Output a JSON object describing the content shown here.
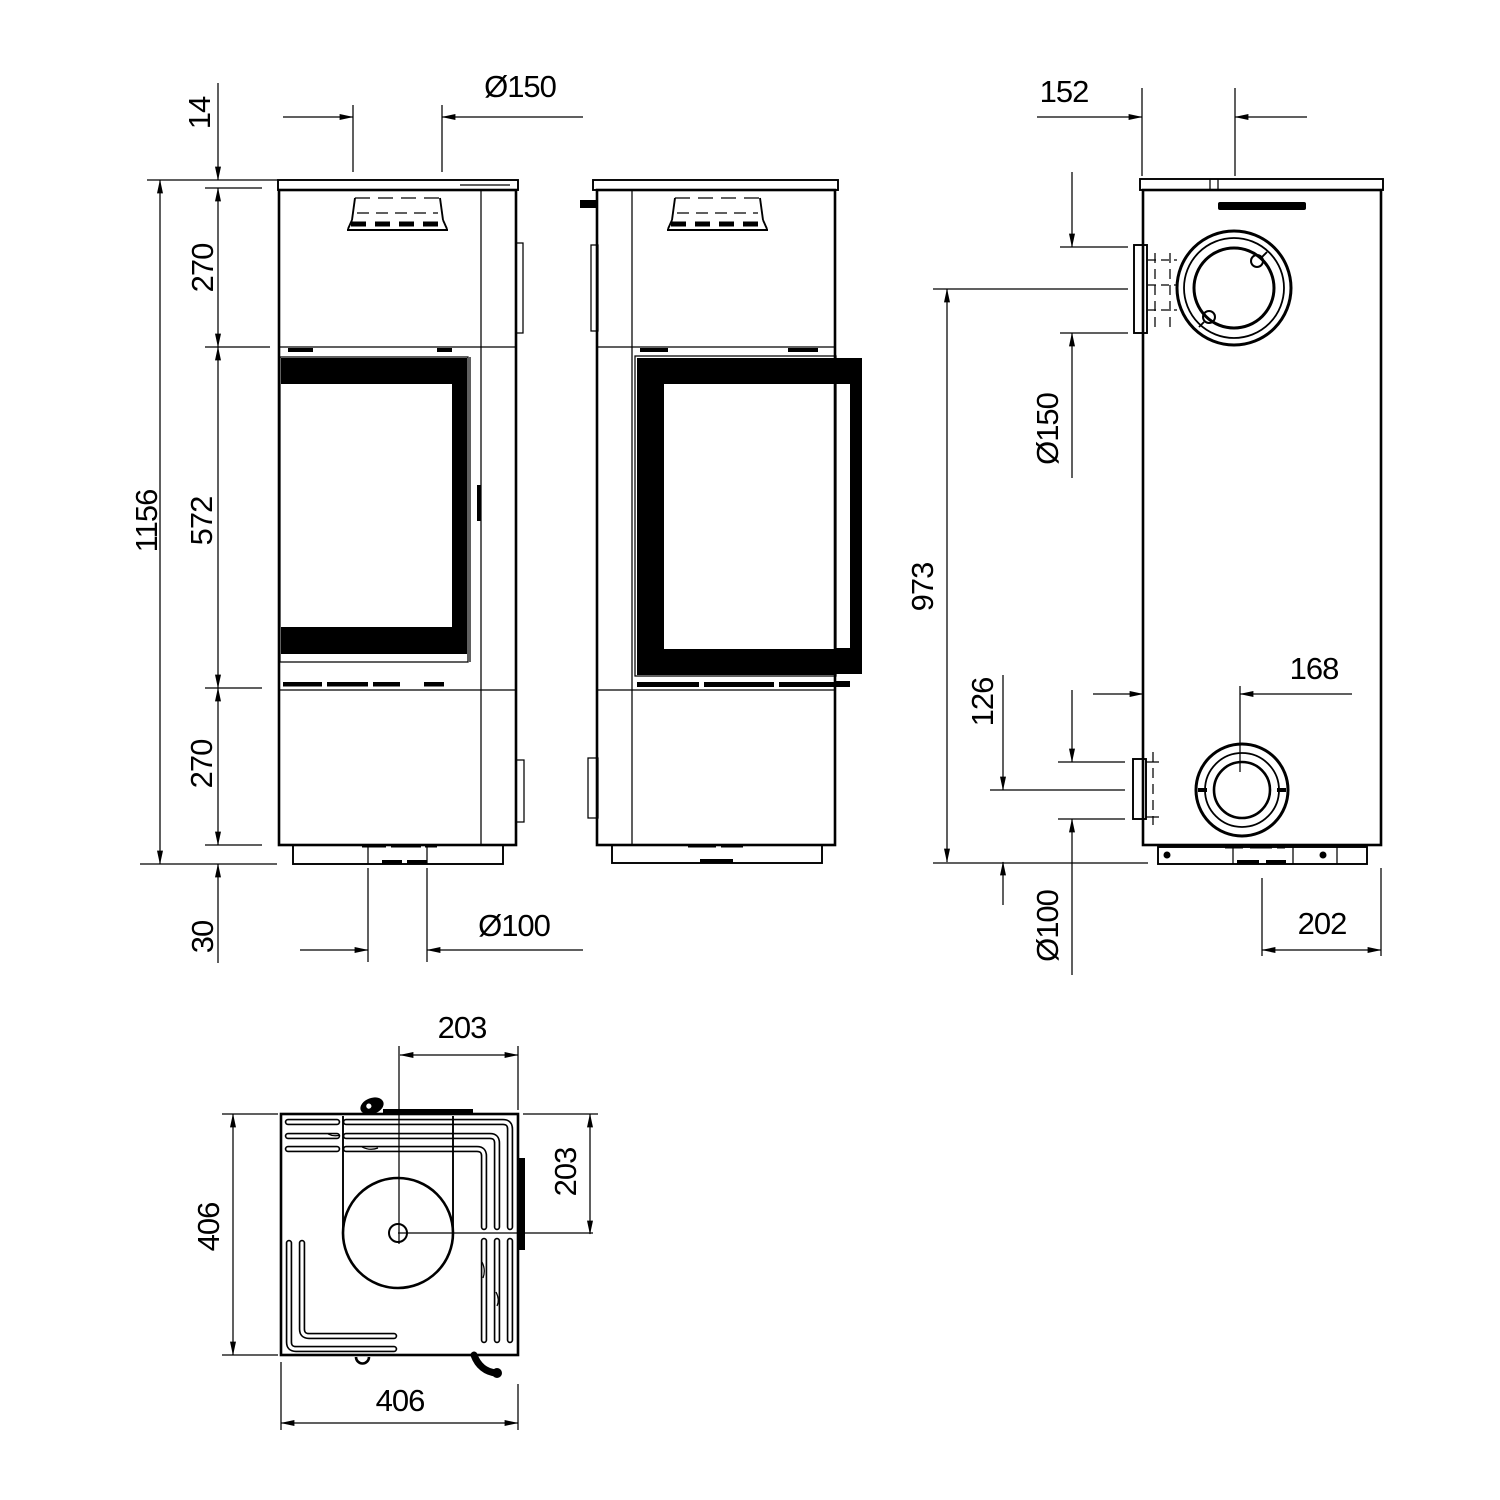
{
  "colors": {
    "line": "#000000",
    "background": "#ffffff"
  },
  "front_view": {
    "dims": {
      "top_plate_thickness": "14",
      "flue_diameter": "Ø150",
      "upper_section": "270",
      "total_height": "1156",
      "glass_section": "572",
      "lower_section": "270",
      "plinth_height": "30",
      "floor_flue_diameter": "Ø100"
    }
  },
  "rear_view": {
    "dims": {
      "flue_offset_from_side": "152",
      "flue_diameter": "Ø150",
      "flue_center_height": "973",
      "outlet_center_height": "126",
      "outlet_offset_from_side": "168",
      "outlet_diameter": "Ø100",
      "base_offset_from_side": "202"
    }
  },
  "top_view": {
    "dims": {
      "flue_center_from_right_edge": "203",
      "flue_center_from_top_edge": "203",
      "depth": "406",
      "width": "406"
    }
  }
}
